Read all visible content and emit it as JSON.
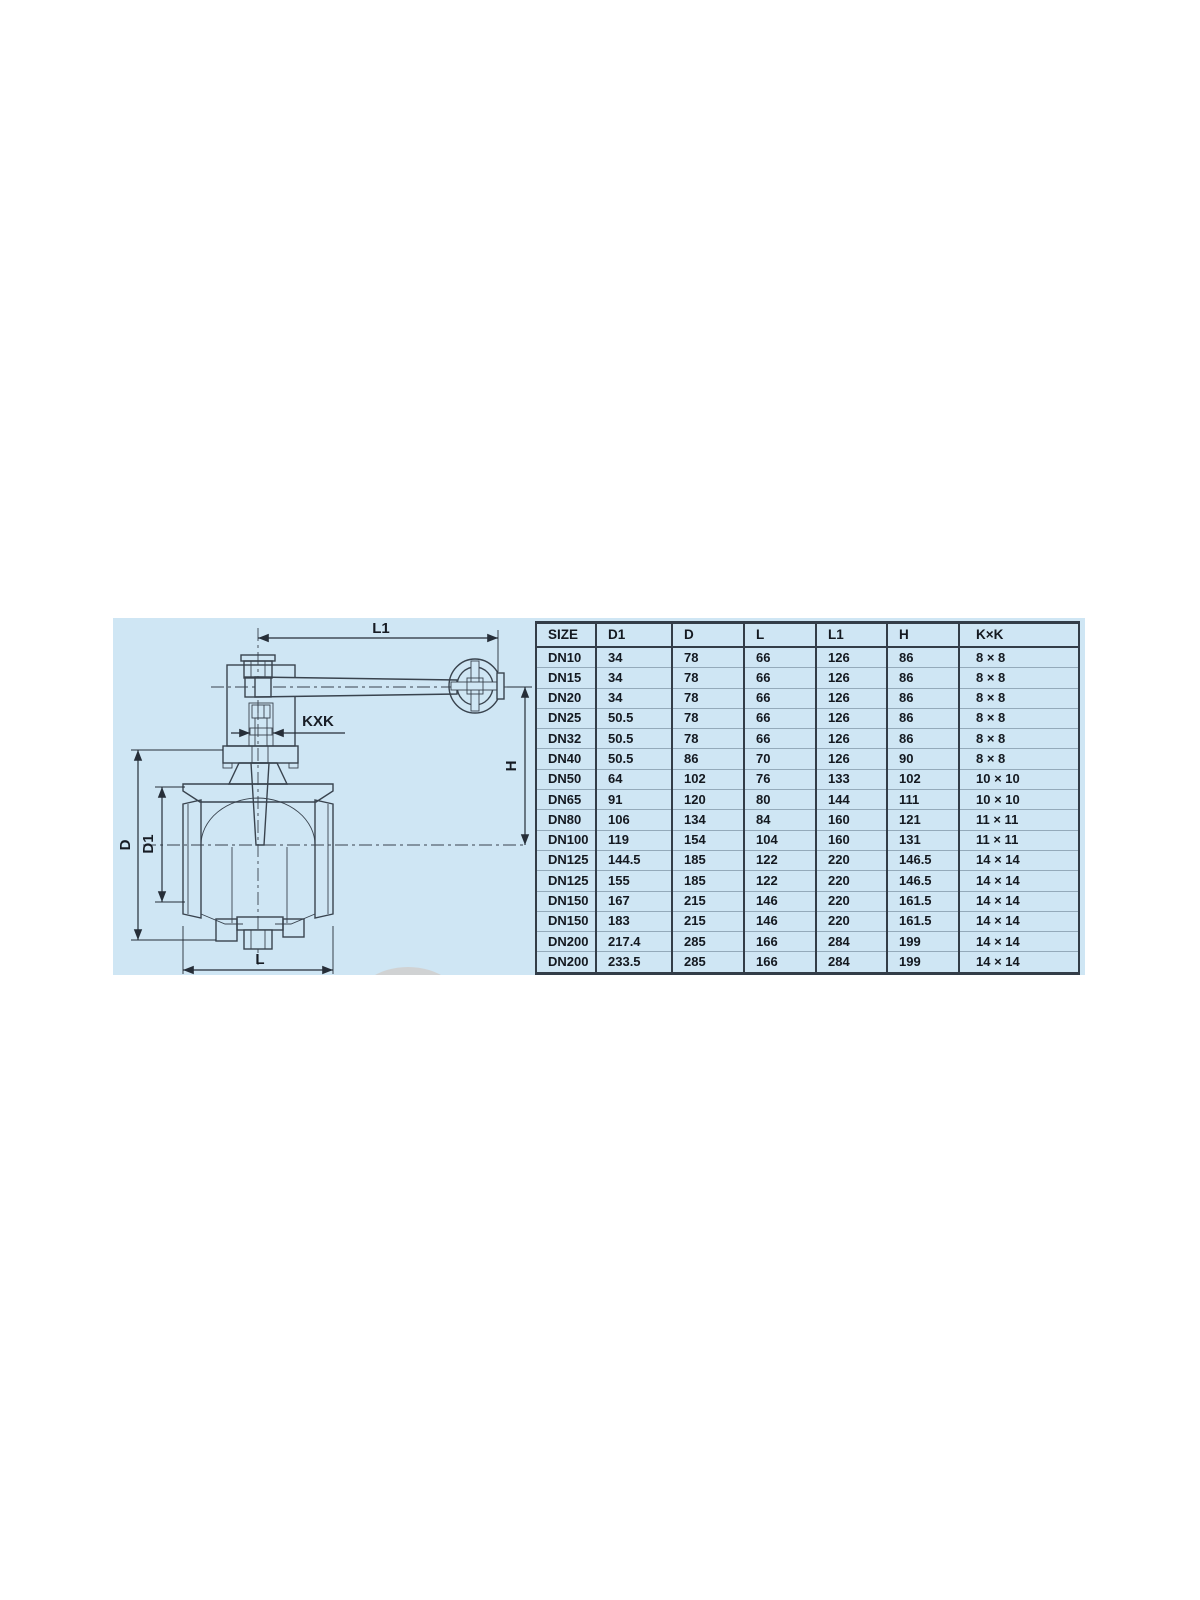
{
  "drawing": {
    "labels": {
      "l1": "L1",
      "kxk": "KXK",
      "h": "H",
      "d": "D",
      "d1": "D1",
      "l": "L"
    }
  },
  "table": {
    "headers": [
      "SIZE",
      "D1",
      "D",
      "L",
      "L1",
      "H",
      "K×K"
    ],
    "rows": [
      [
        "DN10",
        "34",
        "78",
        "66",
        "126",
        "86",
        "8 × 8"
      ],
      [
        "DN15",
        "34",
        "78",
        "66",
        "126",
        "86",
        "8 × 8"
      ],
      [
        "DN20",
        "34",
        "78",
        "66",
        "126",
        "86",
        "8 × 8"
      ],
      [
        "DN25",
        "50.5",
        "78",
        "66",
        "126",
        "86",
        "8 × 8"
      ],
      [
        "DN32",
        "50.5",
        "78",
        "66",
        "126",
        "86",
        "8 × 8"
      ],
      [
        "DN40",
        "50.5",
        "86",
        "70",
        "126",
        "90",
        "8 × 8"
      ],
      [
        "DN50",
        "64",
        "102",
        "76",
        "133",
        "102",
        "10 × 10"
      ],
      [
        "DN65",
        "91",
        "120",
        "80",
        "144",
        "111",
        "10 × 10"
      ],
      [
        "DN80",
        "106",
        "134",
        "84",
        "160",
        "121",
        "11 × 11"
      ],
      [
        "DN100",
        "119",
        "154",
        "104",
        "160",
        "131",
        "11 × 11"
      ],
      [
        "DN125",
        "144.5",
        "185",
        "122",
        "220",
        "146.5",
        "14 × 14"
      ],
      [
        "DN125",
        "155",
        "185",
        "122",
        "220",
        "146.5",
        "14 × 14"
      ],
      [
        "DN150",
        "167",
        "215",
        "146",
        "220",
        "161.5",
        "14 × 14"
      ],
      [
        "DN150",
        "183",
        "215",
        "146",
        "220",
        "161.5",
        "14 × 14"
      ],
      [
        "DN200",
        "217.4",
        "285",
        "166",
        "284",
        "199",
        "14 × 14"
      ],
      [
        "DN200",
        "233.5",
        "285",
        "166",
        "284",
        "199",
        "14 × 14"
      ]
    ]
  },
  "colors": {
    "panel_bg": "#cfe6f4",
    "line_dark": "#333d48",
    "row_divider": "#94aaba",
    "text": "#141920",
    "watermark_gray": "#d0d2d3"
  }
}
